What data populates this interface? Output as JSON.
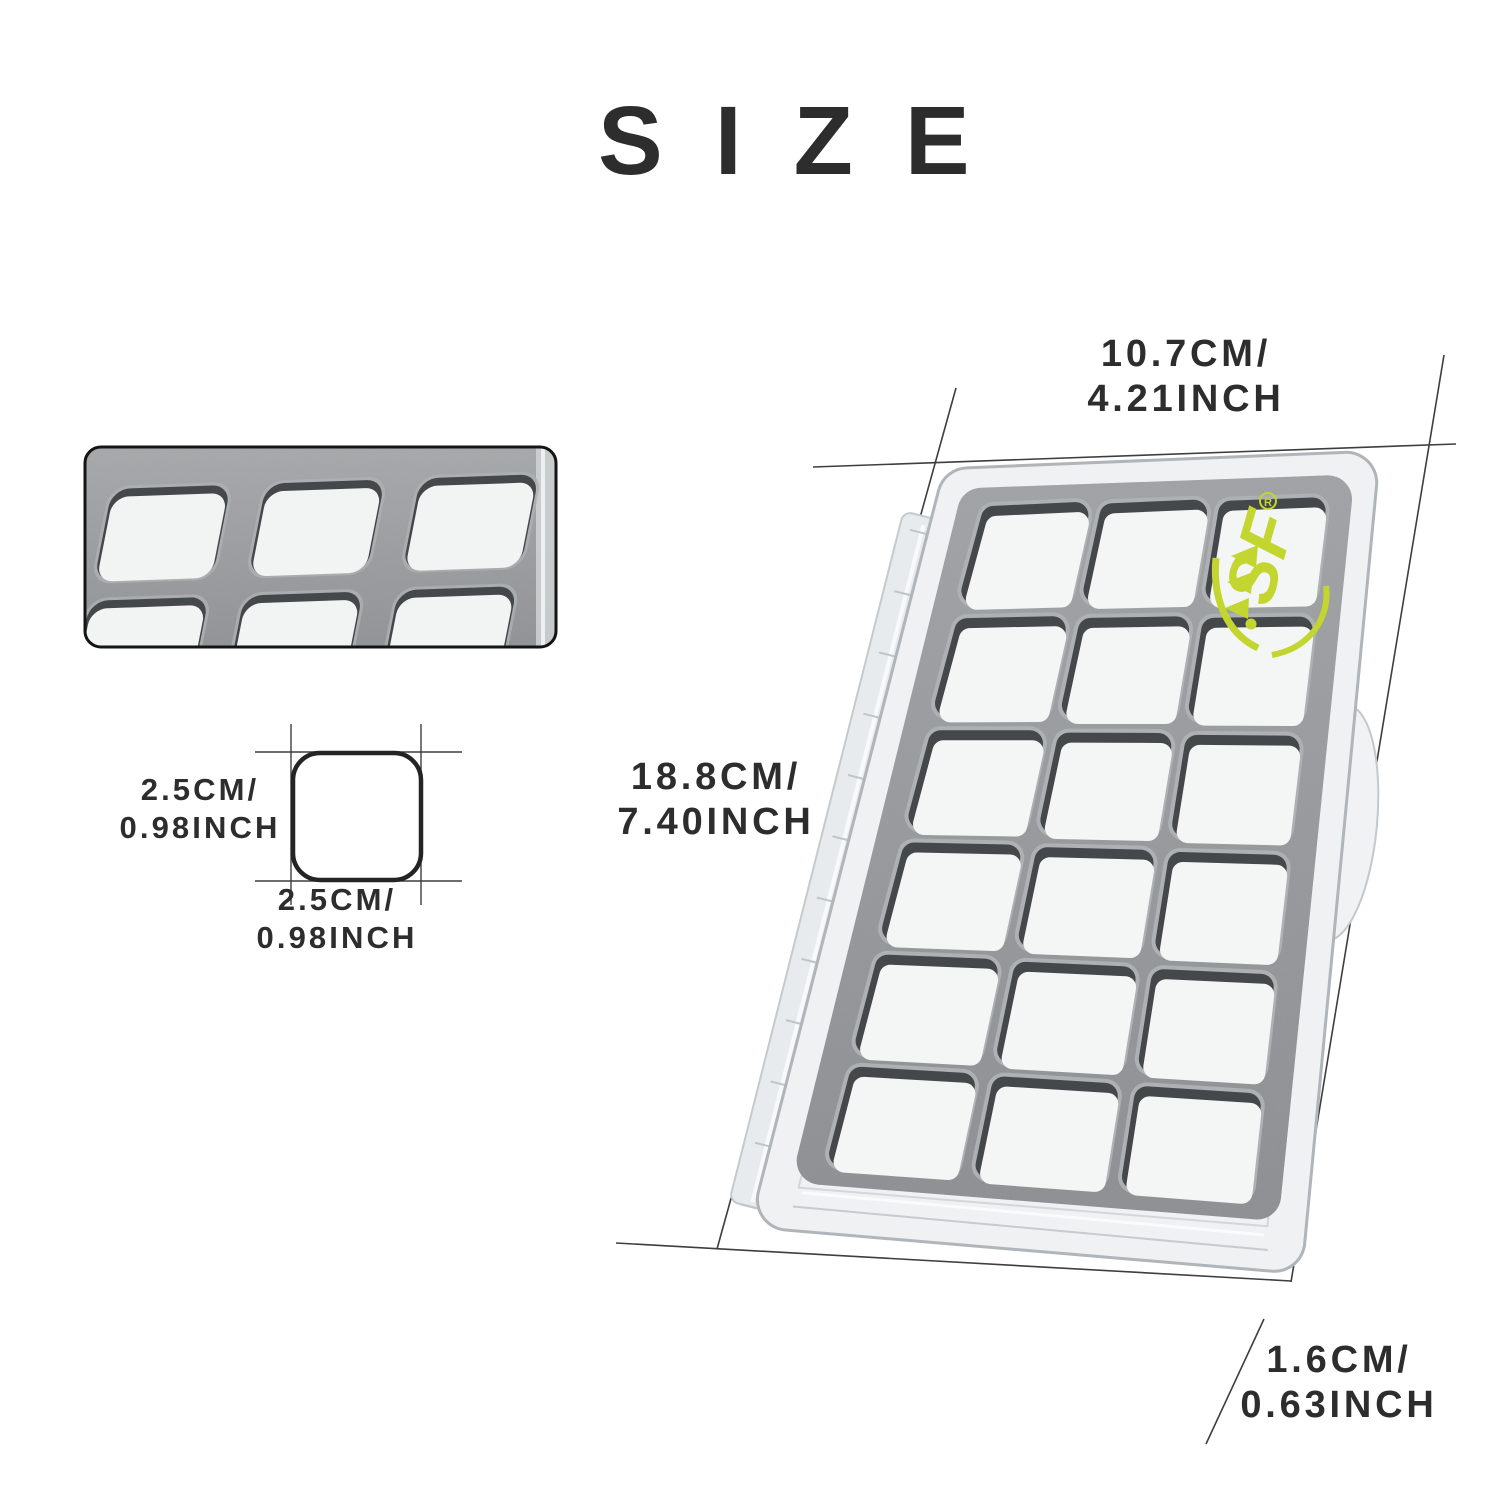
{
  "title": "SIZE",
  "dimensions": {
    "width": {
      "cm": "10.7CM/",
      "inch": "4.21INCH"
    },
    "length": {
      "cm": "18.8CM/",
      "inch": "7.40INCH"
    },
    "thickness": {
      "cm": "1.6CM/",
      "inch": "0.63INCH"
    },
    "cell_width": {
      "cm": "2.5CM/",
      "inch": "0.98INCH"
    },
    "cell_height": {
      "cm": "2.5CM/",
      "inch": "0.98INCH"
    }
  },
  "logo": {
    "text": "SF",
    "registered_mark": "R"
  },
  "box": {
    "grid_rows": 6,
    "grid_cols": 3,
    "inset_rows": 2,
    "inset_cols": 3
  },
  "colors": {
    "text": "#2d2d2d",
    "annotation_line": "#3e3e3e",
    "logo_green": "#c3d62f",
    "foam_gray": "#909294",
    "foam_shadow": "#45484a",
    "foam_highlight": "#aeb1b3",
    "cell_white": "#f4f5f5",
    "shell_light": "#eff1f2",
    "shell_edge": "#b0b5b9",
    "hinge_light": "#e8ebed",
    "square_outline": "#242424"
  }
}
